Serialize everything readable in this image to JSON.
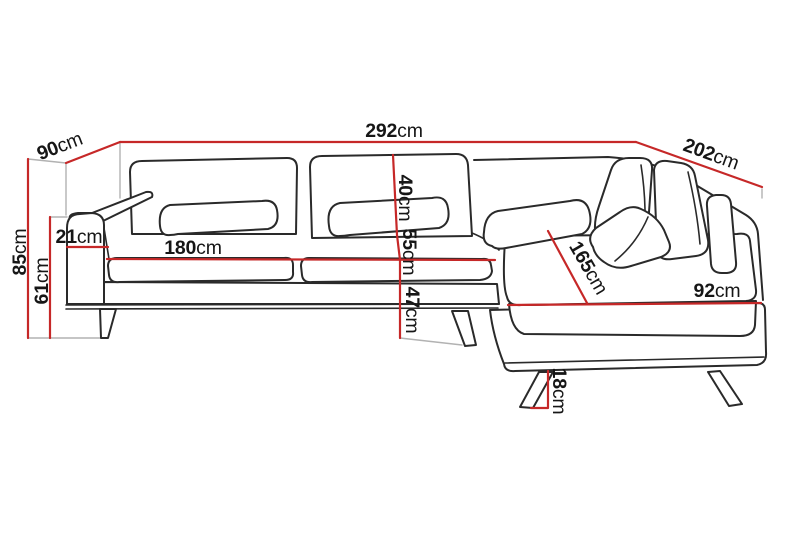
{
  "diagram": {
    "title": "Corner sofa dimension diagram",
    "unit": "cm",
    "colors": {
      "dimension_line": "#c62828",
      "outline": "#2a2a2a",
      "projection_line": "#b2b2b2",
      "label_text": "#161616",
      "background": "#ffffff"
    },
    "measurements": {
      "total_width": {
        "value": "292",
        "unit": "cm"
      },
      "back_depth_left": {
        "value": "90",
        "unit": "cm"
      },
      "side_length_right": {
        "value": "202",
        "unit": "cm"
      },
      "total_height": {
        "value": "85",
        "unit": "cm"
      },
      "armrest_height": {
        "value": "61",
        "unit": "cm"
      },
      "armrest_width": {
        "value": "21",
        "unit": "cm"
      },
      "seat_width": {
        "value": "180",
        "unit": "cm"
      },
      "backrest_height": {
        "value": "40",
        "unit": "cm"
      },
      "seat_depth": {
        "value": "55",
        "unit": "cm"
      },
      "seat_height": {
        "value": "47",
        "unit": "cm"
      },
      "chaise_length": {
        "value": "165",
        "unit": "cm"
      },
      "chaise_width": {
        "value": "92",
        "unit": "cm"
      },
      "leg_height": {
        "value": "18",
        "unit": "cm"
      }
    }
  }
}
